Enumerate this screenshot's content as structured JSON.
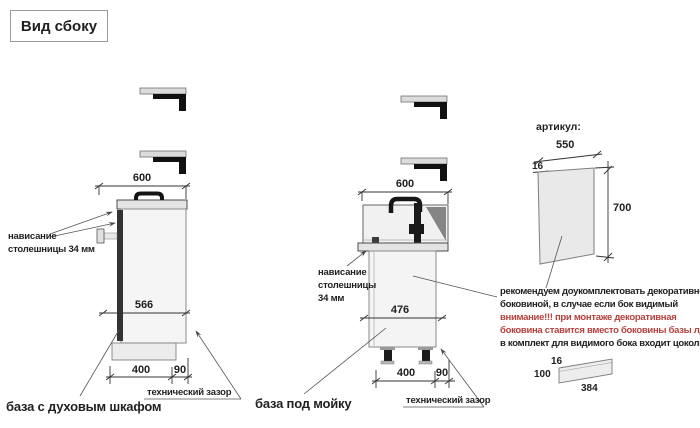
{
  "title": "Вид сбоку",
  "colors": {
    "warning_red": "#b5403c",
    "drawing_line": "#333333"
  },
  "left_cabinet": {
    "name": "база с духовым шкафом",
    "dim_top_width": "600",
    "dim_inner_width": "566",
    "dim_plinth_inset": "400",
    "dim_tech_gap": "90",
    "overhang_label_line1": "нависание",
    "overhang_label_line2": "столешницы 34 мм",
    "tech_gap_label": "технический зазор"
  },
  "sink_cabinet": {
    "name": "база под мойку",
    "dim_top_width": "600",
    "dim_inner_width": "476",
    "dim_plinth_inset": "400",
    "dim_tech_gap": "90",
    "overhang_label_line1": "нависание",
    "overhang_label_line2": "столешницы",
    "overhang_label_line3": "34 мм",
    "tech_gap_label": "технический зазор"
  },
  "decor_panel": {
    "article_label": "артикул:",
    "dim_width": "550",
    "dim_thickness": "16",
    "dim_height": "700",
    "note_line1": "рекомендуем доукомплектовать декоративной",
    "note_line2": "боковиной, в случае если бок видимый",
    "note_line3": "внимание!!! при монтаже декоративная",
    "note_line4": "боковина ставится вместо боковины базы лдсп",
    "note_line5": "в комплект для видимого бока входит цоколь:",
    "plinth_dim_thickness": "16",
    "plinth_dim_height": "100",
    "plinth_dim_length": "384"
  }
}
